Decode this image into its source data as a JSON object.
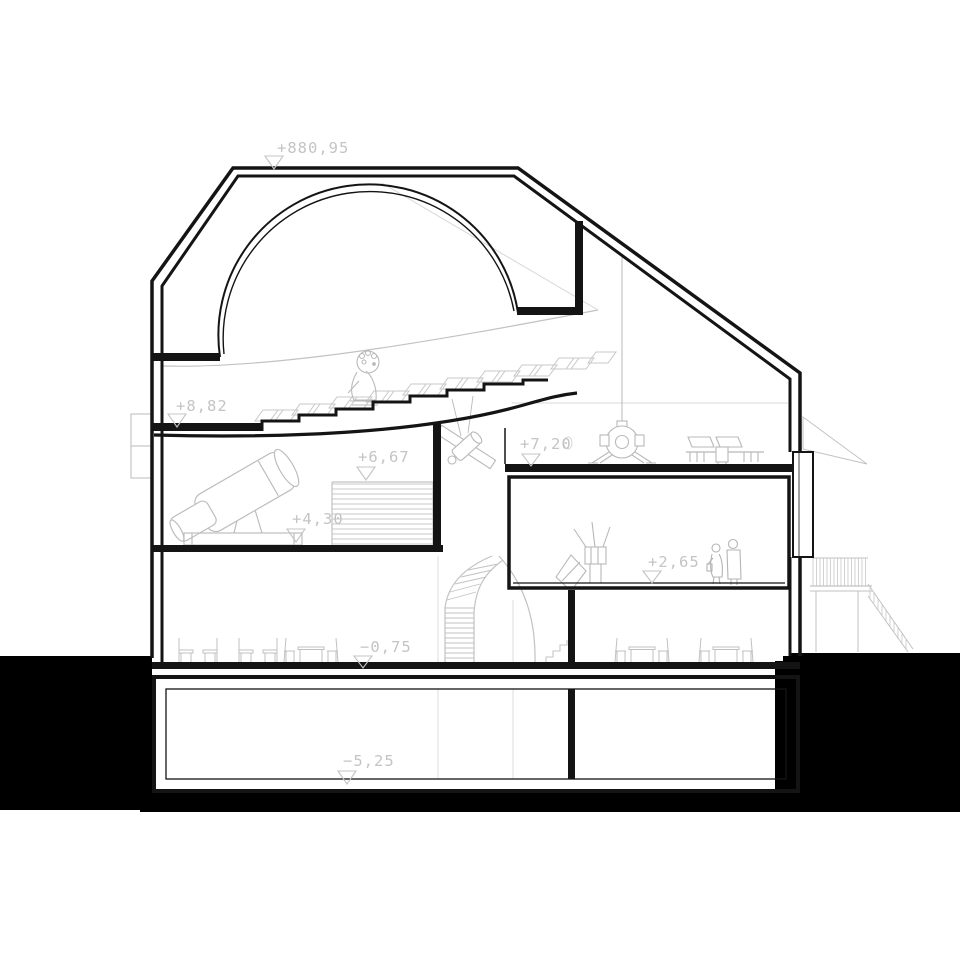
{
  "page": {
    "title": "Planetarium / observatory building section drawing"
  },
  "colors": {
    "background": "#ffffff",
    "ground_fill": "#000000",
    "section_cut": "#141414",
    "backdrop_gray": "#c2c2c2",
    "label_text": "#c4c4c4"
  },
  "levels": [
    {
      "name": "roof-peak",
      "label": "+880,95"
    },
    {
      "name": "planetarium-hall-floor",
      "label": "+8,82"
    },
    {
      "name": "mezzanine-stair",
      "label": "+6,67"
    },
    {
      "name": "telescope-platform",
      "label": "+4,30"
    },
    {
      "name": "upper-exhibition-floor",
      "label": "+7,20"
    },
    {
      "name": "exhibition-room-floor",
      "label": "+2,65"
    },
    {
      "name": "ground-floor",
      "label": "−0,75"
    },
    {
      "name": "basement-floor",
      "label": "−5,25"
    }
  ]
}
